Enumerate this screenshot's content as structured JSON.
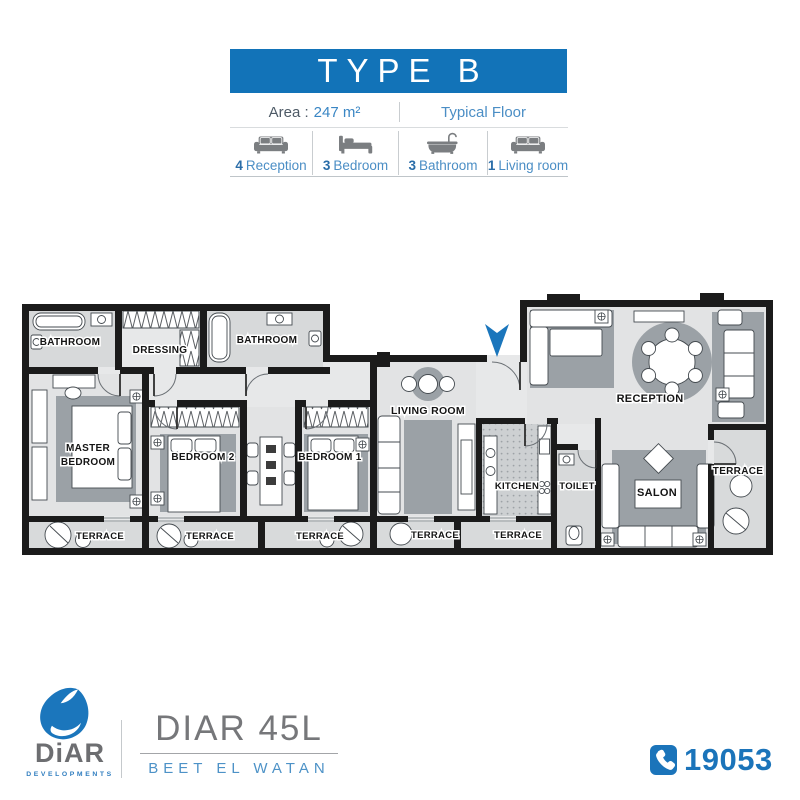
{
  "header": {
    "title": "TYPE B",
    "area_label": "Area :",
    "area_value": "247 m²",
    "floor_type": "Typical Floor"
  },
  "legend": {
    "items": [
      {
        "icon": "sofa-icon",
        "count": "4",
        "label": "Reception"
      },
      {
        "icon": "bed-icon",
        "count": "3",
        "label": "Bedroom"
      },
      {
        "icon": "bathtub-icon",
        "count": "3",
        "label": "Bathroom"
      },
      {
        "icon": "sofa-icon",
        "count": "1",
        "label": "Living room"
      }
    ]
  },
  "floorplan": {
    "bathroom_left": "BATHROOM",
    "dressing": "DRESSING",
    "bathroom_mid": "BATHROOM",
    "master_line1": "MASTER",
    "master_line2": "BEDROOM",
    "bedroom2": "BEDROOM 2",
    "bedroom1": "BEDROOM 1",
    "living_room": "LIVING ROOM",
    "kitchen": "KITCHEN",
    "toilet": "TOILET",
    "reception": "RECEPTION",
    "salon": "SALON",
    "terrace": "TERRACE"
  },
  "footer": {
    "brand": "DiAR",
    "brand_tagline": "DEVELOPMENTS",
    "project": "DIAR 45L",
    "project_tagline": "BEET EL WATAN",
    "phone": "19053"
  },
  "colors": {
    "primary_blue": "#1273b8",
    "label_blue": "#4b8ec5",
    "count_blue": "#2a6da8",
    "wall": "#1b1b1b",
    "floor": "#e3e4e5",
    "rug_gray": "#9ba1a6",
    "brand_gray": "#6d6e71"
  }
}
